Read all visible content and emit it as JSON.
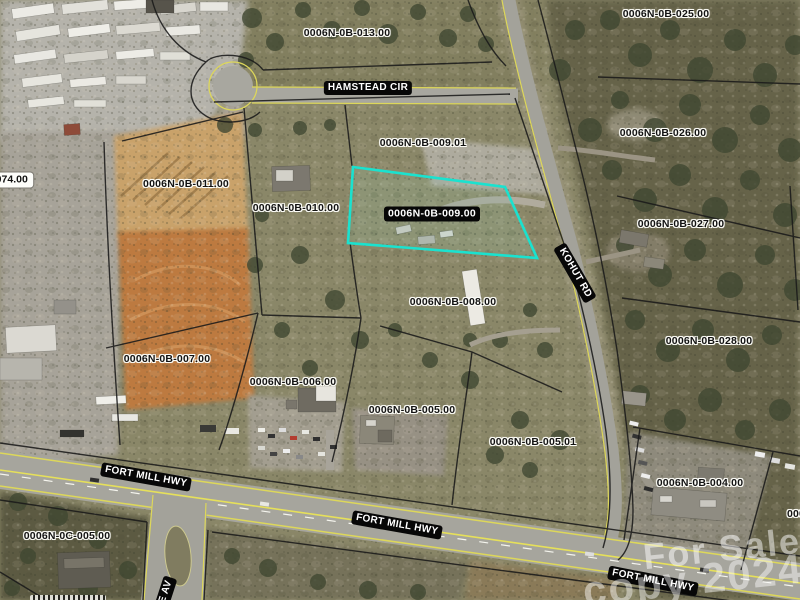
{
  "map": {
    "selected_parcel_id": "0006N-0B-009.00",
    "parcel_labels": [
      {
        "text": "0006N-0B-013.00"
      },
      {
        "text": "0006N-0B-025.00"
      },
      {
        "text": "0006N-0B-026.00"
      },
      {
        "text": "0006N-0B-009.01"
      },
      {
        "text": "0006N-0B-011.00"
      },
      {
        "text": "0006N-0B-010.00"
      },
      {
        "text": "0006N-0B-009.00"
      },
      {
        "text": "0006N-0B-027.00"
      },
      {
        "text": "0006N-0B-008.00"
      },
      {
        "text": "0006N-0B-028.00"
      },
      {
        "text": "0006N-0B-007.00"
      },
      {
        "text": "0006N-0B-006.00"
      },
      {
        "text": "0006N-0B-005.00"
      },
      {
        "text": "0006N-0B-005.01"
      },
      {
        "text": "0006N-0B-004.00"
      },
      {
        "text": "0006N-0C-005.00"
      }
    ],
    "edge_labels": {
      "left_partial": "-074.00",
      "right_partial": "000"
    },
    "road_labels": {
      "hamstead": "HAMSTEAD CIR",
      "kohut": "KOHUT RD",
      "fort_mill_1": "FORT MILL HWY",
      "fort_mill_2": "FORT MILL HWY",
      "fort_mill_3": "FORT MILL HWY",
      "e_av": "E AV"
    },
    "watermark": {
      "line1": "For Sale",
      "line2": "copy 2024"
    },
    "colors": {
      "selected_outline": "#1ae2cf",
      "road_edge_yellow": "#ddd75a",
      "road_label_bg": "#070707",
      "road_label_fg": "#ffffff"
    }
  }
}
